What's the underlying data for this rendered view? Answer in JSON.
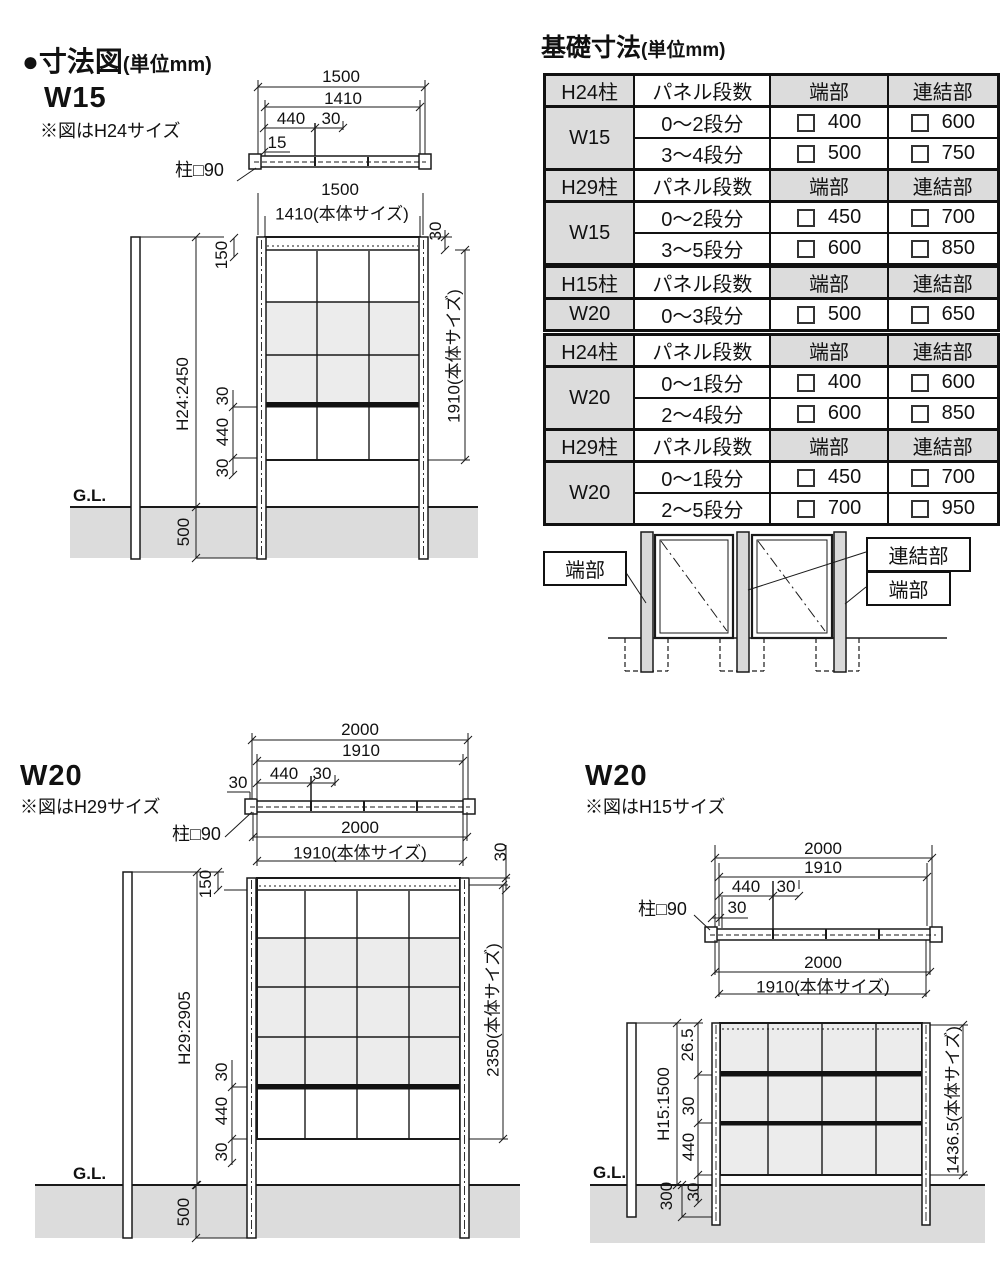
{
  "header": {
    "title": "●寸法図",
    "unit": "(単位mm)"
  },
  "foundation": {
    "title": "基礎寸法",
    "unit": "(単位mm)",
    "headers": {
      "panel": "パネル段数",
      "end": "端部",
      "joint": "連結部"
    },
    "tables": [
      {
        "post": "H24柱",
        "width": "W15",
        "rows": [
          {
            "steps": "0〜2段分",
            "end": "400",
            "joint": "600"
          },
          {
            "steps": "3〜4段分",
            "end": "500",
            "joint": "750"
          }
        ]
      },
      {
        "post": "H29柱",
        "width": "W15",
        "rows": [
          {
            "steps": "0〜2段分",
            "end": "450",
            "joint": "700"
          },
          {
            "steps": "3〜5段分",
            "end": "600",
            "joint": "850"
          }
        ]
      },
      {
        "post": "H15柱",
        "width": "W20",
        "rows": [
          {
            "steps": "0〜3段分",
            "end": "500",
            "joint": "650"
          }
        ]
      },
      {
        "post": "H24柱",
        "width": "W20",
        "rows": [
          {
            "steps": "0〜1段分",
            "end": "400",
            "joint": "600"
          },
          {
            "steps": "2〜4段分",
            "end": "600",
            "joint": "850"
          }
        ]
      },
      {
        "post": "H29柱",
        "width": "W20",
        "rows": [
          {
            "steps": "0〜1段分",
            "end": "450",
            "joint": "700"
          },
          {
            "steps": "2〜5段分",
            "end": "700",
            "joint": "950"
          }
        ]
      }
    ]
  },
  "legend": {
    "end_left": "端部",
    "joint": "連結部",
    "end_right": "端部"
  },
  "w15": {
    "name": "W15",
    "note": "※図はH24サイズ",
    "plan": {
      "overall": "1500",
      "body": "1410",
      "panel": "440",
      "strut": "30",
      "offset": "15",
      "post": "柱□90"
    },
    "elev": {
      "overall": "1500",
      "body": "1410(本体サイズ)",
      "top_margin": "150",
      "top_offset": "30",
      "height": "H24:2450",
      "rail_top": "30",
      "panel_h": "440",
      "rail_bottom": "30",
      "body_h": "1910(本体サイズ)",
      "gl": "G.L.",
      "embed": "500"
    }
  },
  "w20a": {
    "name": "W20",
    "note": "※図はH29サイズ",
    "plan": {
      "overall": "2000",
      "body": "1910",
      "panel": "440",
      "strut": "30",
      "offset": "30",
      "post": "柱□90"
    },
    "elev": {
      "overall": "2000",
      "body": "1910(本体サイズ)",
      "top_margin": "150",
      "top_offset": "30",
      "height": "H29:2905",
      "rail_top": "30",
      "panel_h": "440",
      "rail_bottom": "30",
      "body_h": "2350(本体サイズ)",
      "gl": "G.L.",
      "embed": "500"
    }
  },
  "w20b": {
    "name": "W20",
    "note": "※図はH15サイズ",
    "plan": {
      "overall": "2000",
      "body": "1910",
      "panel": "440",
      "strut": "30",
      "offset": "30",
      "post": "柱□90"
    },
    "elev": {
      "overall": "2000",
      "body": "1910(本体サイズ)",
      "top_margin": "26.5",
      "height": "H15:1500",
      "rail_top": "30",
      "panel_h": "440",
      "rail_bottom": "30",
      "embed": "300",
      "body_h": "1436.5(本体サイズ)",
      "gl": "G.L."
    }
  },
  "colors": {
    "ground": "#dcdcdc",
    "panel_shade": "#ececec",
    "table_header": "#dcdcdc",
    "line": "#1a1a1a"
  }
}
